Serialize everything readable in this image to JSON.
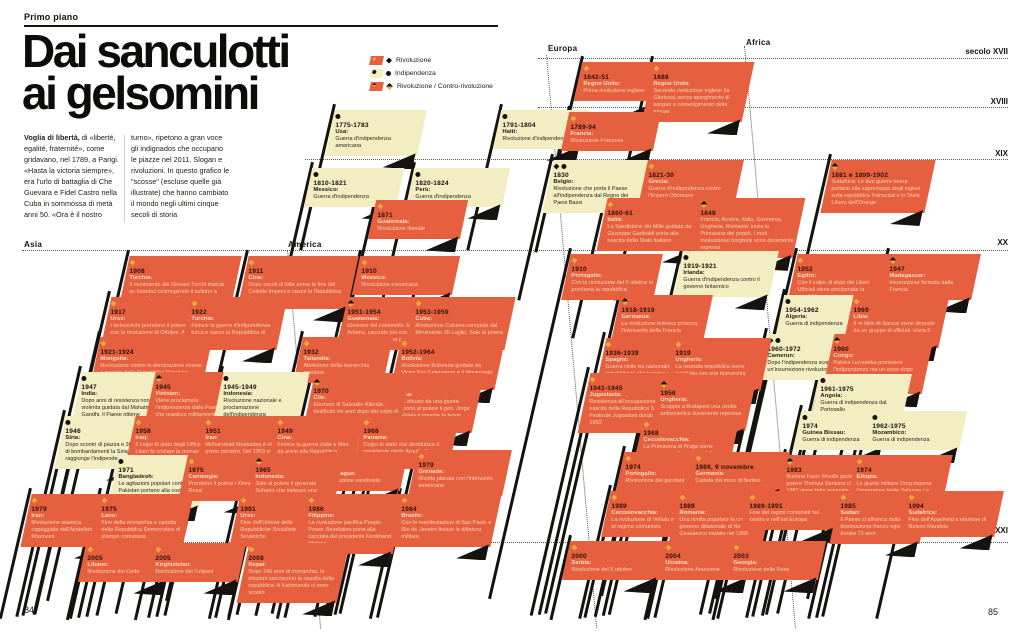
{
  "page": {
    "kicker": "Primo piano",
    "title_line1": "Dai sanculotti",
    "title_line2": "ai gelsomini",
    "intro_lead": "Voglia di libertà,",
    "intro_col1": " di «liberté, egalité, fraternité», come gridavano, nel 1789, a Parigi. «Hasta la victoria siempre», era l'urlo di battaglia di Che Guevara e Fidel Castro nella Cuba in sommossa di metà anni 50. «Ora è il nostro",
    "intro_col2": "turno», ripetono a gran voce gli indignados che occupano le piazze nel 2011. Slogan e rivoluzioni. In questo grafico le \"scosse\" (escluse quelle già illustrate) che hanno cambiato il mondo negli ultimi cinque secoli di storia",
    "left_page_number": "84",
    "right_page_number": "85"
  },
  "colors": {
    "red": "#E6603F",
    "cream": "#F3EDC2",
    "gold": "#E8A83E",
    "ink": "#15130f",
    "text_on_red": "#F8D2B6"
  },
  "legend": {
    "items": [
      {
        "icon": "revolution-diamond",
        "label": "Rivoluzione"
      },
      {
        "icon": "independence-circle",
        "label": "Indipendenza"
      },
      {
        "icon": "counter-revolution-half-diamond",
        "label": "Rivoluzione / Contro-rivoluzione"
      }
    ]
  },
  "regions": [
    {
      "label": "Asia",
      "x": 24,
      "y": 240
    },
    {
      "label": "America",
      "x": 288,
      "y": 240
    },
    {
      "label": "Europa",
      "x": 548,
      "y": 44
    },
    {
      "label": "Africa",
      "x": 746,
      "y": 38
    }
  ],
  "centuries": [
    {
      "label": "secolo XVII",
      "x": 1008,
      "y": 47
    },
    {
      "label": "XVIII",
      "x": 1008,
      "y": 97
    },
    {
      "label": "XIX",
      "x": 1008,
      "y": 149
    },
    {
      "label": "XX",
      "x": 1008,
      "y": 238
    },
    {
      "label": "XXI",
      "x": 1008,
      "y": 526
    }
  ],
  "guides": {
    "h": [
      {
        "x1": 538,
        "y": 58,
        "x2": 1008
      },
      {
        "x1": 538,
        "y": 107,
        "x2": 1008
      },
      {
        "x1": 305,
        "y": 159,
        "x2": 1008
      },
      {
        "x1": 22,
        "y": 250,
        "x2": 1008
      },
      {
        "x1": 22,
        "y": 542,
        "x2": 1008
      }
    ],
    "v": [
      {
        "x": 546,
        "y": 55,
        "h": 575
      },
      {
        "x": 744,
        "y": 46,
        "h": 584
      },
      {
        "x": 287,
        "y": 250,
        "h": 380
      }
    ]
  },
  "flags": [
    {
      "x": 330,
      "y": 110,
      "w": 92,
      "c": "y",
      "i": "i",
      "yr": "1775-1783",
      "p": "Usa:",
      "t": "Guerra d'indipendenza americana"
    },
    {
      "x": 497,
      "y": 110,
      "w": 88,
      "c": "y",
      "i": "i",
      "yr": "1791-1804",
      "p": "Haiti:",
      "t": "Rivoluzione d'indipendenza"
    },
    {
      "x": 308,
      "y": 168,
      "w": 92,
      "c": "y",
      "i": "i",
      "yr": "1810-1821",
      "p": "Messico:",
      "t": "Guerra d'indipendenza"
    },
    {
      "x": 410,
      "y": 168,
      "w": 96,
      "c": "y",
      "i": "i",
      "yr": "1820-1824",
      "p": "Perù:",
      "t": "Guerra d'indipendenza"
    },
    {
      "x": 372,
      "y": 200,
      "w": 92,
      "c": "r",
      "i": "r",
      "yr": "1871",
      "p": "Guatemala:",
      "t": "Rivoluzione liberale"
    },
    {
      "x": 124,
      "y": 256,
      "w": 112,
      "c": "r",
      "i": "r",
      "yr": "1908",
      "p": "Turchia:",
      "t": "Il movimento dei Giovani Turchi marcia su Istanbul costringendo il sultano a concedere una costituzione"
    },
    {
      "x": 243,
      "y": 256,
      "w": 110,
      "c": "r",
      "i": "r",
      "yr": "1911",
      "p": "Cina:",
      "t": "Dopo secoli di lotte arriva la fine del Celeste Impero e nasce la Repubblica cinese"
    },
    {
      "x": 356,
      "y": 256,
      "w": 100,
      "c": "r",
      "i": "r",
      "yr": "1910",
      "p": "Messico:",
      "t": "Rivoluzione messicana"
    },
    {
      "x": 105,
      "y": 297,
      "w": 95,
      "c": "r",
      "i": "r",
      "yr": "1917",
      "p": "Urss:",
      "t": "I bolscevichi prendono il potere con la rivoluzione di Ottobre. A Febbraio era stato abolito lo zarismo"
    },
    {
      "x": 186,
      "y": 297,
      "w": 96,
      "c": "r",
      "i": "r",
      "yr": "1922",
      "p": "Turchia:",
      "t": "Finisce la guerra d'indipendenza turca e nasce la Repubblica di Turchia"
    },
    {
      "x": 342,
      "y": 297,
      "w": 100,
      "c": "r",
      "i": "c",
      "yr": "1951-1954",
      "p": "Guatemala:",
      "t": "Elezione del colonnello Jacobo Arbenz, cacciato poi con un colpo di stato guidato da una giunta militare"
    },
    {
      "x": 410,
      "y": 297,
      "w": 100,
      "c": "r",
      "i": "r",
      "yr": "1953-1959",
      "p": "Cuba:",
      "t": "Rivoluzione Cubana compiuta dal Movimento 26 Luglio. Sale al potere Fidel Castro"
    },
    {
      "x": 95,
      "y": 337,
      "w": 112,
      "c": "r",
      "i": "r",
      "yr": "1921-1924",
      "p": "Mongolia:",
      "t": "Rivoluzione contro la dominazione cinese e nascita della Repubblica Popolare Mongola di stampo sovietico"
    },
    {
      "x": 298,
      "y": 337,
      "w": 90,
      "c": "r",
      "i": "r",
      "yr": "1932",
      "p": "Tailandia:",
      "t": "Abolizione della monarchia assoluta"
    },
    {
      "x": 396,
      "y": 337,
      "w": 104,
      "c": "r",
      "i": "r",
      "yr": "1952-1964",
      "p": "Bolivia:",
      "t": "Rivoluzione Boliviana guidata da Victor Paz Estenssoro e il Movimento Nazionale Rivoluzionario"
    },
    {
      "x": 76,
      "y": 372,
      "w": 88,
      "c": "y",
      "i": "i",
      "yr": "1947",
      "p": "India:",
      "t": "Dopo anni di resistenza non violenta guidata dal Mahatma Gandhi, il Paese ottiene l'indipendenza dall'Inghilterra."
    },
    {
      "x": 150,
      "y": 372,
      "w": 84,
      "c": "r",
      "i": "c",
      "yr": "1945",
      "p": "Vietnam:",
      "t": "Viene proclamata l'indipendenza dalla Francia che reagisce militarmente"
    },
    {
      "x": 218,
      "y": 372,
      "w": 86,
      "c": "y",
      "i": "i",
      "yr": "1945-1949",
      "p": "Indonesia:",
      "t": "Rivoluzione nazionale e proclamazione dell'indipendenza"
    },
    {
      "x": 308,
      "y": 376,
      "w": 96,
      "c": "r",
      "i": "c",
      "yr": "1970",
      "p": "Cile:",
      "t": "Elezione di Salvador Allende, destituito tre anni dopo dal colpo di stato guidato dal generale Pinochet"
    },
    {
      "x": 378,
      "y": 373,
      "w": 100,
      "c": "r",
      "i": "r",
      "yr": "1976",
      "p": "Argentina:",
      "t": "Un golpe attuato da una giunta militare porta al potere il gen. Jorge Rafael Videla e impone la legge marziale"
    },
    {
      "x": 60,
      "y": 416,
      "w": 86,
      "c": "y",
      "i": "i",
      "yr": "1946",
      "p": "Siria:",
      "t": "Dopo scontri di piazza e 36 ore di bombardamenti la Siria raggiunge l'indipendenza"
    },
    {
      "x": 130,
      "y": 416,
      "w": 90,
      "c": "r",
      "i": "r",
      "yr": "1958",
      "p": "Iraq:",
      "t": "Il colpo di stato degli Ufficiali Liberi fa crollare la monarchia e instaura una repubblica"
    },
    {
      "x": 200,
      "y": 416,
      "w": 88,
      "c": "r",
      "i": "r",
      "yr": "1951",
      "p": "Iran:",
      "t": "Mohammad Mossadeq è eletto primo ministro. Nel 1953 viene deposto da un colpo di stato sostenuto dalla Cia."
    },
    {
      "x": 272,
      "y": 416,
      "w": 86,
      "c": "r",
      "i": "r",
      "yr": "1949",
      "p": "Cina:",
      "t": "Finisce la guerra civile e Mao dà avvio alla Repubblica Popolare cinese"
    },
    {
      "x": 358,
      "y": 416,
      "w": 96,
      "c": "r",
      "i": "r",
      "yr": "1968",
      "p": "Panama:",
      "t": "Colpo di stato che destituisce il presidente eletto Arnulfo Arias Madrid"
    },
    {
      "x": 113,
      "y": 455,
      "w": 92,
      "c": "y",
      "i": "i",
      "yr": "1971",
      "p": "Bangladesh:",
      "t": "Le agitazioni popolari contro il Pakistan portano alla costruzione di uno Stato indipendente"
    },
    {
      "x": 183,
      "y": 455,
      "w": 80,
      "c": "r",
      "i": "r",
      "yr": "1975",
      "p": "Cambogia:",
      "t": "Prendono il potere i Khmer Rossi"
    },
    {
      "x": 250,
      "y": 455,
      "w": 88,
      "c": "r",
      "i": "c",
      "yr": "1965",
      "p": "Indonesia:",
      "t": "Sale al potere il generale Suharto che instaura una dittatura. Nel 1998 si dimette dopo proteste"
    },
    {
      "x": 320,
      "y": 452,
      "w": 84,
      "c": "r",
      "i": "r",
      "yr": "1979",
      "p": "Nicaragua:",
      "t": "Rivoluzione sandinista"
    },
    {
      "x": 413,
      "y": 450,
      "w": 94,
      "c": "r",
      "i": "r",
      "yr": "1979",
      "p": "Grenada:",
      "t": "Rivolta placata con l'intervento americano"
    },
    {
      "x": 26,
      "y": 494,
      "w": 88,
      "c": "r",
      "i": "r",
      "yr": "1979",
      "p": "Iran:",
      "t": "Rivoluzione islamica capeggiata dall'Ayatollah Khomeini"
    },
    {
      "x": 96,
      "y": 494,
      "w": 92,
      "c": "r",
      "i": "r",
      "yr": "1975",
      "p": "Laos:",
      "t": "Fine della monarchia e nascita della Repubblica Democratica di stampo comunista"
    },
    {
      "x": 235,
      "y": 494,
      "w": 92,
      "c": "r",
      "i": "r",
      "yr": "1991",
      "p": "Urss:",
      "t": "Fine dell'Unione delle Repubbliche Socialiste Sovietiche"
    },
    {
      "x": 303,
      "y": 494,
      "w": 96,
      "c": "r",
      "i": "r",
      "yr": "1986",
      "p": "Filippine:",
      "t": "La rivoluzione pacifica People Power Revolution porta alla cacciata del presidente Ferdinand Marcos"
    },
    {
      "x": 396,
      "y": 494,
      "w": 100,
      "c": "r",
      "i": "r",
      "yr": "1984",
      "p": "Brasile:",
      "t": "Con le manifestazioni di San Paolo e Rio de Janeiro finisce la dittatura militare"
    },
    {
      "x": 82,
      "y": 543,
      "w": 90,
      "c": "r",
      "i": "r",
      "yr": "2005",
      "p": "Libano:",
      "t": "Rivoluzione dei Cedri"
    },
    {
      "x": 150,
      "y": 543,
      "w": 92,
      "c": "r",
      "i": "r",
      "yr": "2005",
      "p": "Kirghizistan:",
      "t": "Rivoluzione dei Tulipani"
    },
    {
      "x": 243,
      "y": 543,
      "w": 100,
      "c": "r",
      "i": "r",
      "yr": "2008",
      "p": "Nepal:",
      "t": "Dopo 240 anni di monarchia, le elezioni sanciscono la nascita della repubblica. A Kathmandu ci sono scontri"
    },
    {
      "x": 578,
      "y": 62,
      "w": 92,
      "c": "r",
      "i": "r",
      "yr": "1642-51",
      "p": "Regno Unito:",
      "t": "Prima rivoluzione inglese"
    },
    {
      "x": 648,
      "y": 62,
      "w": 100,
      "c": "r",
      "i": "r",
      "yr": "1688",
      "p": "Regno Unito:",
      "t": "Seconda rivoluzione inglese (la Gloriosa) senza spargimento di sangue e coinvolgimento delle masse"
    },
    {
      "x": 565,
      "y": 112,
      "w": 92,
      "c": "r",
      "i": "r",
      "yr": "1789-94",
      "p": "Francia:",
      "t": "Rivoluzione Francese"
    },
    {
      "x": 548,
      "y": 160,
      "w": 96,
      "c": "y",
      "i": "ri",
      "yr": "1830",
      "p": "Belgio:",
      "t": "Rivoluzione che porta il Paese all'indipendenza dal Regno dei Paesi Bassi"
    },
    {
      "x": 643,
      "y": 160,
      "w": 96,
      "c": "r",
      "i": "r",
      "yr": "1821-30",
      "p": "Grecia:",
      "t": "Guerra d'indipendenza contro l'Impero Ottomano"
    },
    {
      "x": 602,
      "y": 198,
      "w": 100,
      "c": "r",
      "i": "r",
      "yr": "1860-61",
      "p": "Italia:",
      "t": "La Spedizione dei Mille guidata da Giuseppe Garibaldi porta alla nascita dello Stato italiano"
    },
    {
      "x": 695,
      "y": 198,
      "w": 104,
      "c": "r",
      "i": "c",
      "yr": "1848",
      "p": "",
      "t": "Francia, Austria, Italia, Germania, Ungheria, Romania: inizia la Primavera dei popoli. I moti rivoluzionari borghesi sono duramente repressi"
    },
    {
      "x": 826,
      "y": 160,
      "w": 104,
      "c": "r",
      "i": "c",
      "yr": "1881 e 1899-1902",
      "p": "",
      "t": "Sudafrica: Le due guerre boere portano alla supremazia degli inglesi sulla repubblica Transvaal e lo Stato Libero dell'Orange"
    },
    {
      "x": 566,
      "y": 254,
      "w": 92,
      "c": "r",
      "i": "r",
      "yr": "1910",
      "p": "Portogallo:",
      "t": "Con la rivoluzione del 5 ottobre si proclama la repubblica"
    },
    {
      "x": 678,
      "y": 251,
      "w": 96,
      "c": "y",
      "i": "i",
      "yr": "1919-1921",
      "p": "Irlanda:",
      "t": "Guerra d'indipendenza contro il governo britannico"
    },
    {
      "x": 792,
      "y": 254,
      "w": 92,
      "c": "r",
      "i": "r",
      "yr": "1952",
      "p": "Egitto:",
      "t": "Con il colpo di stato dei Liberi Ufficiali viene proclamata la repubblica"
    },
    {
      "x": 884,
      "y": 254,
      "w": 92,
      "c": "r",
      "i": "c",
      "yr": "1947",
      "p": "Madagascar:",
      "t": "Insurrezione fermata dalla Francia"
    },
    {
      "x": 616,
      "y": 295,
      "w": 92,
      "c": "r",
      "i": "c",
      "yr": "1918-1919",
      "p": "Germania:",
      "t": "La rivoluzione tedesca provoca l'intervento della Francia"
    },
    {
      "x": 780,
      "y": 295,
      "w": 96,
      "c": "y",
      "i": "i",
      "yr": "1954-1962",
      "p": "Algeria:",
      "t": "Guerra di indipendenza"
    },
    {
      "x": 848,
      "y": 295,
      "w": 96,
      "c": "r",
      "i": "r",
      "yr": "1969",
      "p": "Libia:",
      "t": "Il re Idris Al-Sanusi viene deposto da un gruppo di ufficiali. Inizia il regime di Muammar Gheddafi"
    },
    {
      "x": 600,
      "y": 338,
      "w": 100,
      "c": "r",
      "i": "r",
      "yr": "1936-1939",
      "p": "Spagna:",
      "t": "Guerra civile tra nazionalisti e repubblicani che termina con la nascita del regime di Francisco Franco"
    },
    {
      "x": 670,
      "y": 338,
      "w": 96,
      "c": "r",
      "i": "r",
      "yr": "1919",
      "p": "Ungheria:",
      "t": "La neonata repubblica viene sostituita con una monarchia parlamentare"
    },
    {
      "x": 762,
      "y": 334,
      "w": 94,
      "c": "y",
      "i": "ri",
      "yr": "1960-1972",
      "p": "Camerun:",
      "t": "Dopo l'indipendenza scoppia un'insurrezione rivoluzionaria"
    },
    {
      "x": 828,
      "y": 334,
      "w": 100,
      "c": "r",
      "i": "c",
      "yr": "1960",
      "p": "Congo:",
      "t": "Patrice Lumumba promuove l'indipendenza ma un anno dopo viene condannato a morte dal colonnello Mobutu"
    },
    {
      "x": 584,
      "y": 373,
      "w": 100,
      "c": "r",
      "i": "r",
      "yr": "1941-1945",
      "p": "Jugoslavia:",
      "t": "Resistenza all'occupazione nazista e nascita della Repubblica Socialista Federale Jugoslava durata fino al 1992"
    },
    {
      "x": 655,
      "y": 378,
      "w": 96,
      "c": "r",
      "i": "c",
      "yr": "1956",
      "p": "Ungheria:",
      "t": "Scoppia a Budapest una rivolta antisovietica duramente repressa dalle truppe dell'Urss"
    },
    {
      "x": 815,
      "y": 374,
      "w": 92,
      "c": "y",
      "i": "i",
      "yr": "1961-1975",
      "p": "Angola:",
      "t": "Guerra di indipendenza dal Portogallo"
    },
    {
      "x": 638,
      "y": 418,
      "w": 96,
      "c": "r",
      "i": "r",
      "yr": "1968",
      "p": "Cecoslovacchia:",
      "t": "La Primavera di Praga viene repressa con l'invasione delle truppe sovietiche"
    },
    {
      "x": 797,
      "y": 411,
      "w": 90,
      "c": "y",
      "i": "i",
      "yr": "1974",
      "p": "Guinea Bissau:",
      "t": "Guerra di indipendenza"
    },
    {
      "x": 867,
      "y": 411,
      "w": 96,
      "c": "y",
      "i": "i",
      "yr": "1962-1975",
      "p": "Mozambico:",
      "t": "Guerra di indipendenza"
    },
    {
      "x": 620,
      "y": 452,
      "w": 88,
      "c": "r",
      "i": "r",
      "yr": "1974",
      "p": "Portogallo:",
      "t": "Rivoluzione dei garofani"
    },
    {
      "x": 690,
      "y": 452,
      "w": 96,
      "c": "r",
      "i": "r",
      "yr": "1989, 9 novembre",
      "p": "Germania:",
      "t": "Caduta del muro di Berlino"
    },
    {
      "x": 781,
      "y": 455,
      "w": 96,
      "c": "r",
      "i": "c",
      "yr": "1983",
      "p": "",
      "t": "Burkina Faso: Rivolte portano al potere Thomas Sankara che nel 1987 viene fatto assassinare dal suo vice che instaura un regime"
    },
    {
      "x": 851,
      "y": 455,
      "w": 96,
      "c": "r",
      "i": "r",
      "yr": "1974",
      "p": "Etiopia:",
      "t": "La giunta militare Dreg depone l'imperatore Haile Selassie I e instaura un regime socialista"
    },
    {
      "x": 606,
      "y": 491,
      "w": 94,
      "c": "r",
      "i": "r",
      "yr": "1989",
      "p": "Cecoslovacchia:",
      "t": "La rivoluzione di Velluto mette fine al regime comunista"
    },
    {
      "x": 674,
      "y": 491,
      "w": 94,
      "c": "r",
      "i": "r",
      "yr": "1989",
      "p": "Romania:",
      "t": "Una rivolta popolare fa crollare il governo dittatoriale di Nicolae Ceausescu iniziato nel 1965"
    },
    {
      "x": 744,
      "y": 491,
      "w": 96,
      "c": "r",
      "i": "r",
      "yr": "1989-1991",
      "p": "",
      "t": "Fine dei regimi comunisti nel centro e nell'est Europa"
    },
    {
      "x": 835,
      "y": 491,
      "w": 90,
      "c": "r",
      "i": "r",
      "yr": "1985",
      "p": "Sudan:",
      "t": "Il Paese si affranca dalla dominazione franco-egiziana durata 73 anni"
    },
    {
      "x": 903,
      "y": 491,
      "w": 96,
      "c": "r",
      "i": "r",
      "yr": "1994",
      "p": "Sudafrica:",
      "t": "Fine dell'Apartheid e elezione di Nelson Mandela"
    },
    {
      "x": 566,
      "y": 541,
      "w": 96,
      "c": "r",
      "i": "r",
      "yr": "2000",
      "p": "Serbia:",
      "t": "Rivoluzione del 5 ottobre"
    },
    {
      "x": 660,
      "y": 541,
      "w": 92,
      "c": "r",
      "i": "r",
      "yr": "2004",
      "p": "Ucraina:",
      "t": "Rivoluzione Arancione"
    },
    {
      "x": 728,
      "y": 541,
      "w": 94,
      "c": "r",
      "i": "r",
      "yr": "2003",
      "p": "Georgia:",
      "t": "Rivoluzione delle Rose"
    }
  ]
}
